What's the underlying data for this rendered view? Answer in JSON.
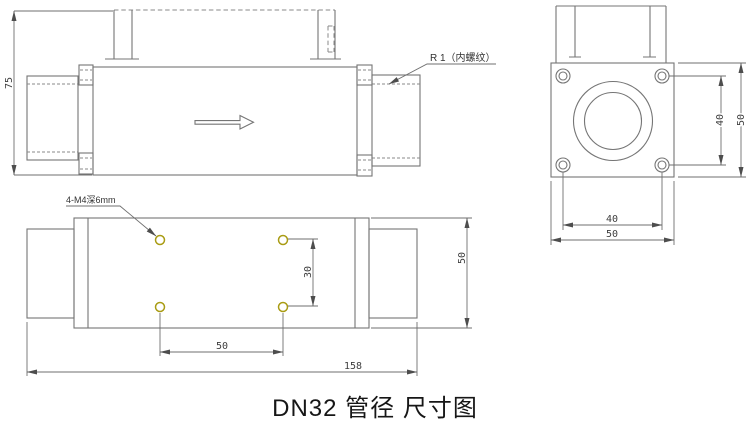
{
  "caption": {
    "text": "DN32 管径 尺寸图"
  },
  "side_view": {
    "overall_height": "75",
    "thread_label": "R 1（内螺纹）"
  },
  "front_view": {
    "bolt_spacing_vertical": "40",
    "flange_height": "50",
    "bolt_spacing_horizontal": "40",
    "flange_width": "50"
  },
  "bottom_view": {
    "mounting_holes_label": "4-M4深6mm",
    "hole_pitch_vertical": "30",
    "hole_pitch_horizontal": "50",
    "overall_length": "158",
    "body_width": "50"
  },
  "colors": {
    "object_line": "#757575",
    "dimension_line": "#6f6f6f",
    "mounting_hole_accent": "#a99c14",
    "caption_text": "#161616"
  }
}
